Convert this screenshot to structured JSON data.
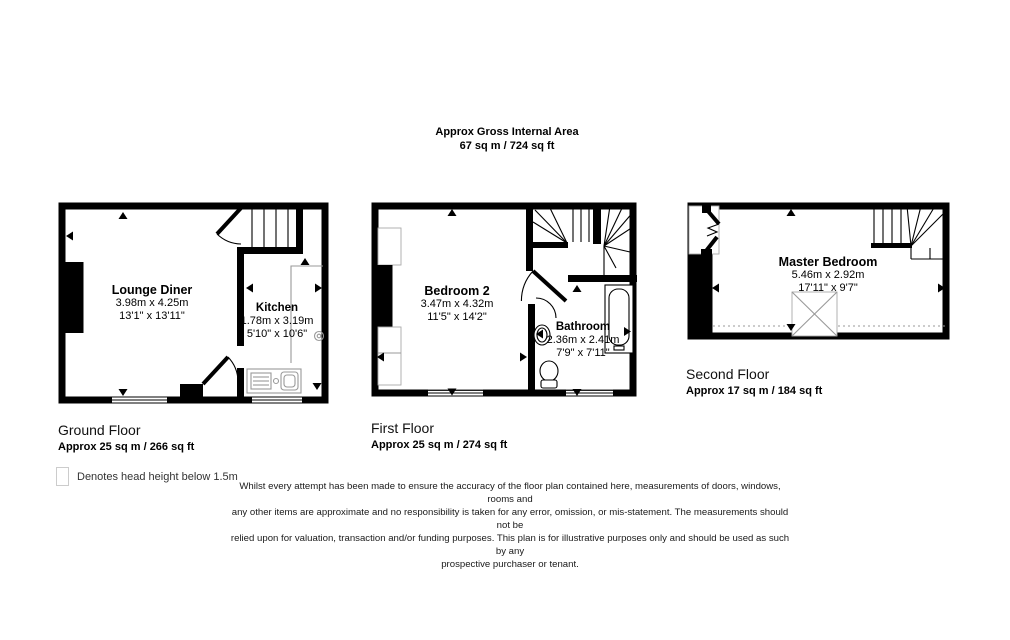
{
  "title": {
    "line1": "Approx Gross Internal Area",
    "line2": "67 sq m / 724 sq ft"
  },
  "floors": {
    "ground": {
      "name": "Ground Floor",
      "area": "Approx 25 sq m / 266 sq ft",
      "rooms": {
        "lounge": {
          "name": "Lounge Diner",
          "metric": "3.98m x 4.25m",
          "imperial": "13'1\" x 13'11\""
        },
        "kitchen": {
          "name": "Kitchen",
          "metric": "1.78m x 3.19m",
          "imperial": "5'10\" x 10'6\""
        }
      }
    },
    "first": {
      "name": "First Floor",
      "area": "Approx 25 sq m / 274 sq ft",
      "rooms": {
        "bedroom2": {
          "name": "Bedroom 2",
          "metric": "3.47m x 4.32m",
          "imperial": "11'5\" x 14'2\""
        },
        "bathroom": {
          "name": "Bathroom",
          "metric": "2.36m x 2.41m",
          "imperial": "7'9\" x 7'11\""
        }
      }
    },
    "second": {
      "name": "Second Floor",
      "area": "Approx 17 sq m / 184 sq ft",
      "rooms": {
        "master": {
          "name": "Master Bedroom",
          "metric": "5.46m x 2.92m",
          "imperial": "17'11\" x 9'7\""
        }
      }
    }
  },
  "legend": {
    "icon": "head-height-box",
    "text": "Denotes head height below 1.5m"
  },
  "disclaimer": {
    "lines": [
      "Whilst every attempt has been made to ensure the accuracy of the floor plan contained here, measurements of doors, windows, rooms and",
      "any other items are approximate and no responsibility is taken for any error, omission, or mis-statement. The measurements should not be",
      "relied upon for valuation, transaction and/or funding purposes. This plan is for illustrative purposes only and should be used as such by any",
      "prospective purchaser or tenant."
    ]
  },
  "colors": {
    "wall": "#000000",
    "fixture": "#999999",
    "background": "#ffffff"
  }
}
